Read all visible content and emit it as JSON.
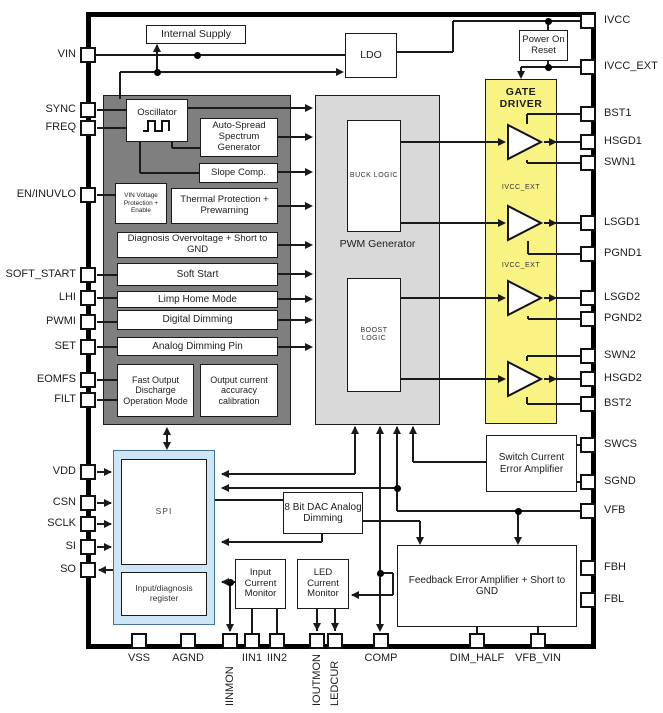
{
  "diagram_title": "LED driver IC block diagram",
  "pins": {
    "left": [
      "VIN",
      "SYNC",
      "FREQ",
      "EN/INUVLO",
      "SOFT_START",
      "LHI",
      "PWMI",
      "SET",
      "EOMFS",
      "FILT",
      "VDD",
      "CSN",
      "SCLK",
      "SI",
      "SO"
    ],
    "right": [
      "IVCC",
      "IVCC_EXT",
      "BST1",
      "HSGD1",
      "SWN1",
      "LSGD1",
      "PGND1",
      "LSGD2",
      "PGND2",
      "SWN2",
      "HSGD2",
      "BST2",
      "SWCS",
      "SGND",
      "VFB",
      "FBH",
      "FBL"
    ],
    "bottom": [
      "VSS",
      "AGND",
      "IINMON",
      "IIN1",
      "IIN2",
      "IOUTMON",
      "LEDCUR",
      "COMP",
      "DIM_HALF",
      "VFB_VIN"
    ]
  },
  "blocks": {
    "internal_supply": "Internal Supply",
    "ldo": "LDO",
    "power_on_reset": "Power On Reset",
    "oscillator": "Oscillator",
    "auto_spread": "Auto-Spread Spectrum Generator",
    "slope_comp": "Slope Comp.",
    "vin_protection": "VIN Voltage Protection + Enable",
    "thermal": "Thermal Protection + Prewarning",
    "diagnosis": "Diagnosis Overvoltage + Short to GND",
    "soft_start": "Soft Start",
    "limp_home": "Limp Home Mode",
    "digital_dimming": "Digital Dimming",
    "analog_dimming": "Analog Dimming Pin",
    "fast_output": "Fast Output Discharge Operation Mode",
    "output_current": "Output current accuracy calibration",
    "pwm_generator": "PWM Generator",
    "buck_logic": "BUCK LOGIC",
    "boost_logic": "BOOST LOGIC",
    "gate_driver": "GATE DRIVER",
    "ivcc_ext_label": "IVCC_EXT",
    "switch_current": "Switch Current Error Amplifier",
    "spi": "SPI",
    "input_diag_register": "Input/diagnosis register",
    "dac": "8 Bit DAC Analog Dimming",
    "input_current_monitor": "Input Current Monitor",
    "led_current_monitor": "LED Current Monitor",
    "feedback_amp": "Feedback Error Amplifier + Short to GND"
  },
  "colors": {
    "control_block": "#7f7f7f",
    "pwm_block": "#d9d9d9",
    "gate_driver": "#f8f383",
    "spi_fill": "#cde5f4",
    "line": "#1a1a1a"
  }
}
